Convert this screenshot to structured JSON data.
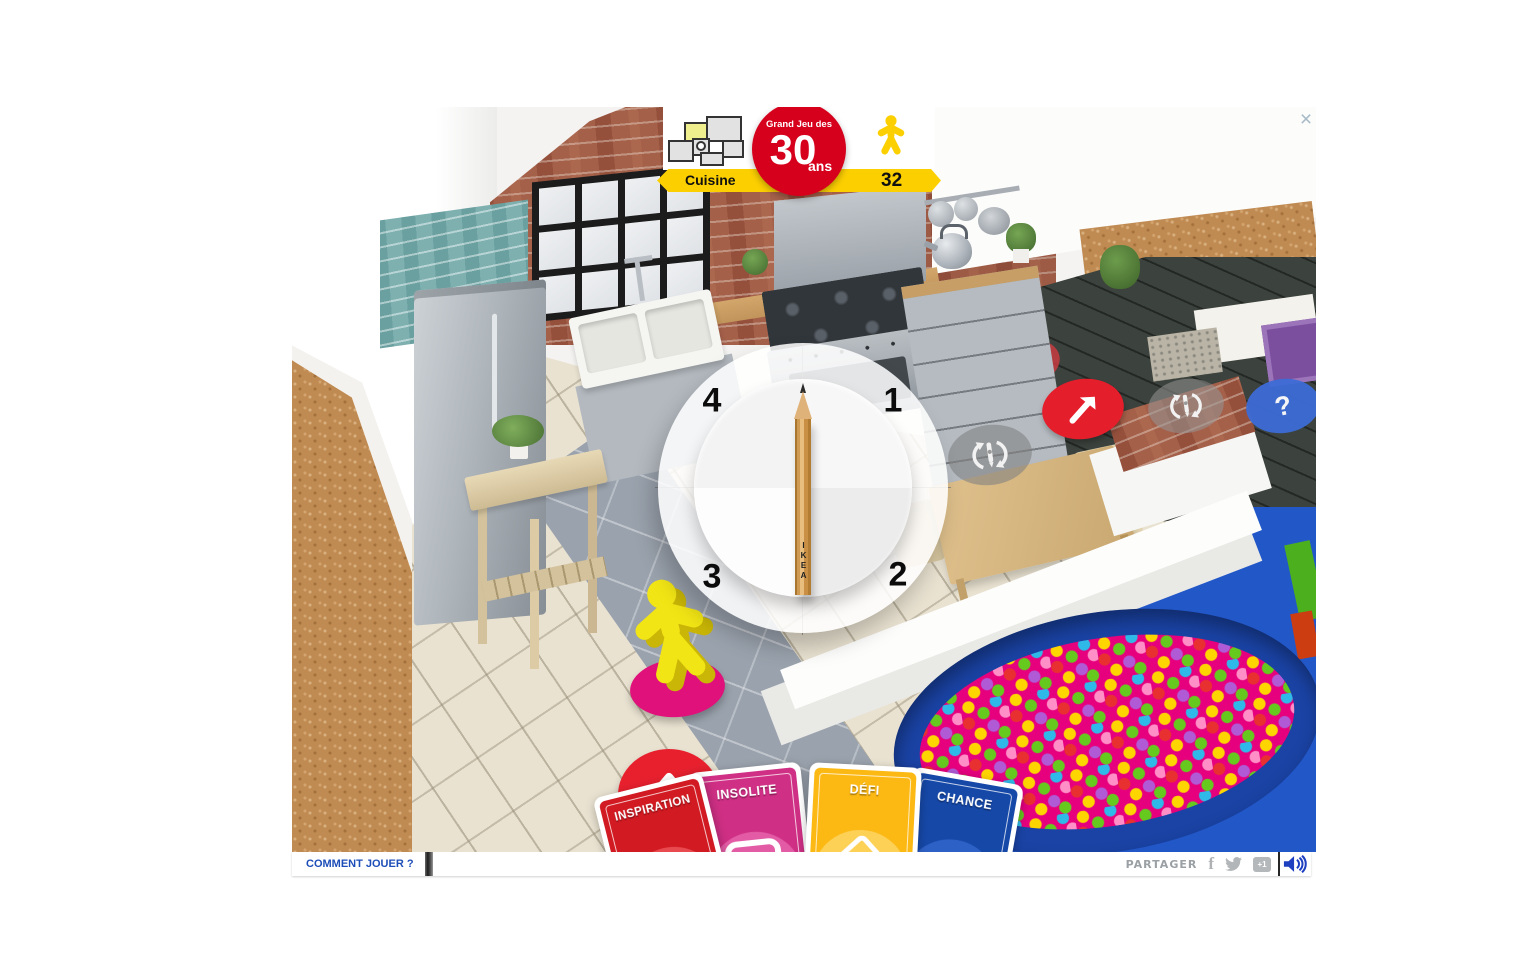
{
  "window": {
    "close_label": "×"
  },
  "header": {
    "tagline": "Grand Jeu des",
    "big_number": "30",
    "suffix": "ans",
    "room": "Cuisine",
    "count": "32",
    "colors": {
      "badge_red": "#d6001c",
      "banner_yellow": "#fccf00",
      "star_yellow": "#fcd000"
    }
  },
  "spinner": {
    "numbers": {
      "top_left": "4",
      "top_right": "1",
      "bottom_right": "2",
      "bottom_left": "3"
    },
    "pencil_brand": "IKEA"
  },
  "board": {
    "question_mark": "?",
    "piece_color": "#f2e515",
    "space_colors": {
      "advance_red": "#e8202e",
      "start_pink": "#e0117a",
      "question_blue": "#3d6cd6",
      "spin_gray": "rgba(130,130,130,0.6)"
    },
    "icons": {
      "spin_space": "pencil-rotate-icon",
      "advance_space": "arrow-up-icon",
      "advance_space_diagonal": "arrow-ne-icon",
      "player_piece": "ikea-family-figure"
    }
  },
  "cards": [
    {
      "label": "INSPIRATION",
      "color": "#d11a22",
      "circle": "#e84a50"
    },
    {
      "label": "INSOLITE",
      "color": "#cf2f84",
      "circle": "#e25ba4",
      "icon": "frame-icon"
    },
    {
      "label": "DÉFI",
      "color": "#fcb813",
      "circle": "#fdd056",
      "icon": "dice-icon"
    },
    {
      "label": "CHANCE",
      "color": "#1648a8",
      "circle": "#2e61c6"
    }
  ],
  "bottom_bar": {
    "how_to_play": "COMMENT JOUER ?",
    "share": "PARTAGER",
    "google_plus": "+1",
    "icons": {
      "facebook": "facebook-icon",
      "twitter": "twitter-icon",
      "gplus": "google-plus-one-icon",
      "sound": "speaker-icon"
    }
  }
}
